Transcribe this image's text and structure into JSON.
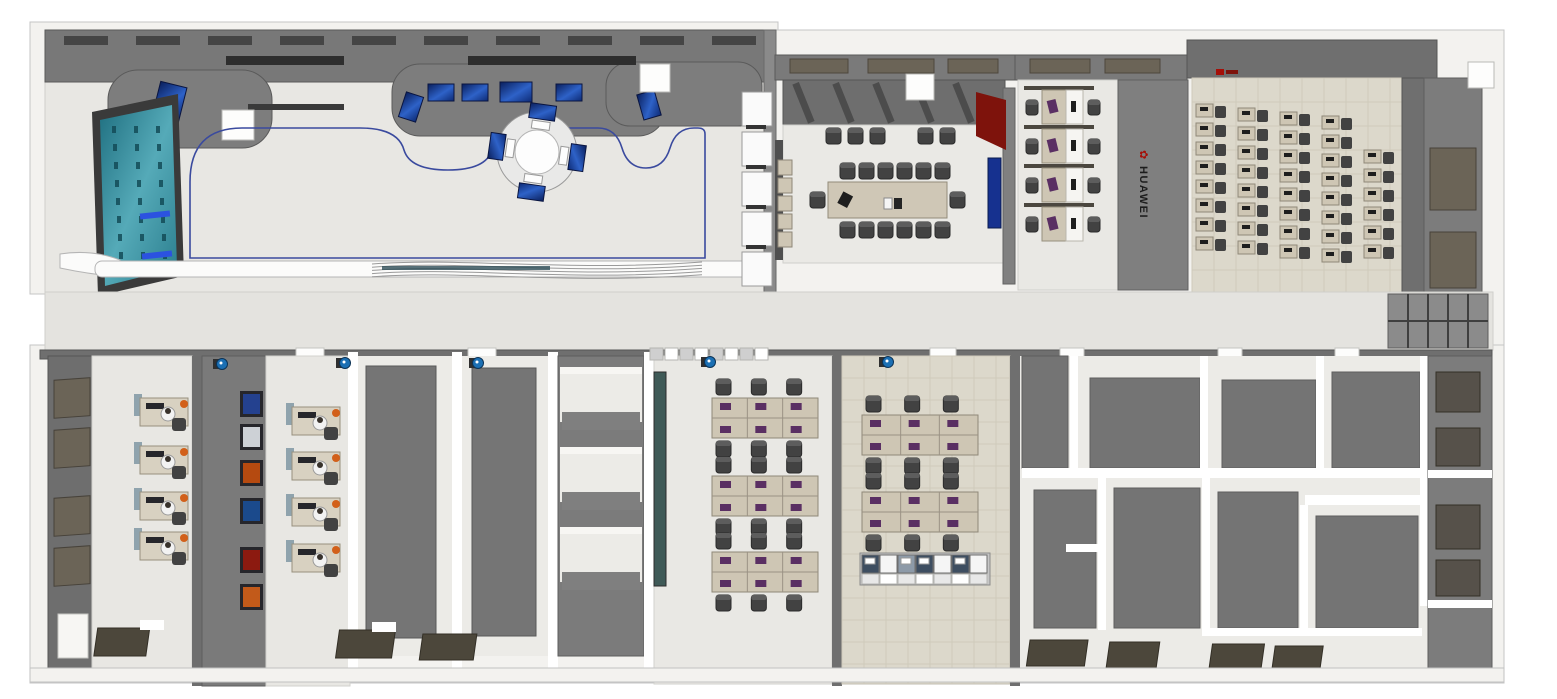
{
  "scene": {
    "description": "top-down 3D render of an office floor plan",
    "canvas": {
      "width": 1557,
      "height": 699
    }
  },
  "branding": {
    "logo_text": "HUAWEI",
    "logo_flower_glyph": "✿",
    "logo_text_color": "#1c1c1c",
    "logo_flower_color": "#a50f08"
  },
  "palette": {
    "exterior_wall": "#f3f2ef",
    "wall": "#767676",
    "wall_dark": "#555555",
    "wall_light": "#8c8c8c",
    "floor_light": "#e8e7e3",
    "floor_tile": "#dcd8cb",
    "corridor": "#e4e3df",
    "ceiling_slot": "#454545",
    "screen_blue": "#16318f",
    "video_wall_teal": "#2a7d8d",
    "accent_red": "#7e130c",
    "glass_olive": "#6b6457",
    "glass_teal": "#3f5a57",
    "desk_tan": "#cec6b4",
    "desk_white": "#f6f5f2",
    "chair_dark": "#424242",
    "monitor_purple": "#5a2f63",
    "monitor_dark": "#1e1e1e",
    "person_white": "#f2f2f2",
    "accent_orange": "#d2601a",
    "path_line_blue": "#3a4a9e",
    "camera_lens_blue": "#1b6fb3",
    "counter_white": "#fbfbfa"
  },
  "rooms": {
    "exhibition_hall": {
      "kiosk_screens": 4,
      "display_cases": 5,
      "alcove_screens": 6,
      "video_walls": 1
    },
    "conference_room": {
      "table_seats": 14,
      "wall_seats": 5,
      "tv_screens": 1,
      "shelf_units": 5
    },
    "cubicle_office": {
      "rows": 4,
      "desks_per_row": 2
    },
    "training_room": {
      "desk_columns": 5,
      "desk_rows": 8,
      "last_column_rows": 6
    },
    "team_office_large": {
      "bench_rows": 3,
      "seats_per_bench": 6
    },
    "team_office_small": {
      "bench_rows": 2,
      "seats_per_bench": 6,
      "lab_bench_segments": 7
    },
    "monitor_room_west": {
      "workstations": 4,
      "window_panes": 4
    },
    "gallery_office": {
      "workstations": 4,
      "artwork_frames": 6
    },
    "security_cameras": 5
  },
  "artwork_frame_colors": [
    "#24418f",
    "#cdd1d6",
    "#b54a10",
    "#1b4a8c",
    "#8c1a10",
    "#c25a1a"
  ],
  "lab_bench_segment_colors": [
    "#3e4e61",
    "#f5f5f5",
    "#8d9aa8",
    "#3e4e61",
    "#f5f5f5",
    "#3e4e61",
    "#f5f5f5"
  ]
}
